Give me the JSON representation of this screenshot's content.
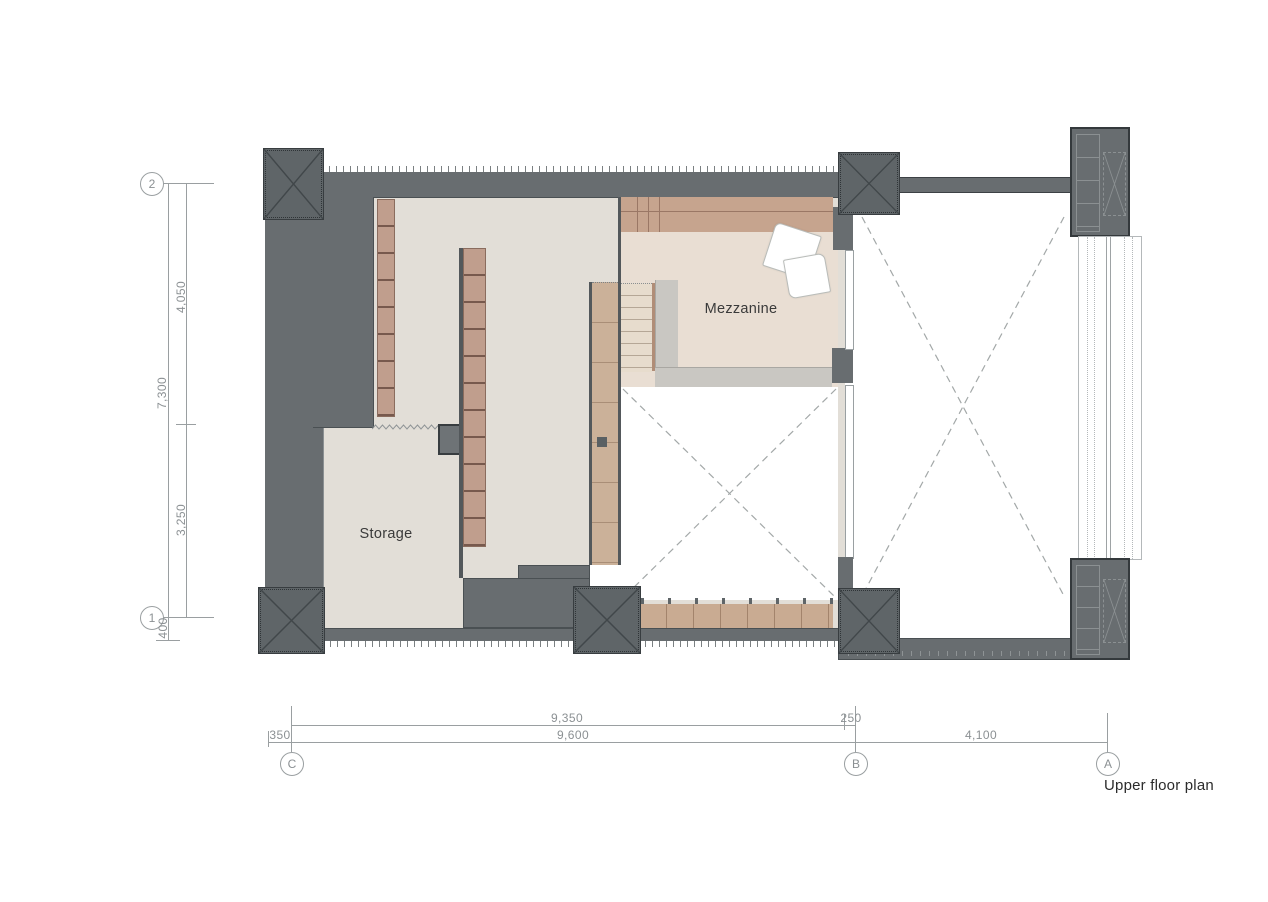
{
  "title": {
    "label": "Upper floor plan"
  },
  "rooms": {
    "storage": "Storage",
    "mezzanine": "Mezzanine"
  },
  "grid": {
    "h": {
      "g2": "2",
      "g1": "1"
    },
    "v": {
      "gC": "C",
      "gB": "B",
      "gA": "A"
    }
  },
  "dims": {
    "left": {
      "d4050": "4,050",
      "d7300": "7,300",
      "d3250": "3,250",
      "d400": "400"
    },
    "bottom": {
      "d9350": "9,350",
      "d250": "250",
      "d350": "350",
      "d9600": "9,600",
      "d4100": "4,100"
    }
  },
  "colors": {
    "wall": "#686d70",
    "column": "#5f6568",
    "floor": "#e2ded7",
    "mezzanine_floor": "#e9ded3",
    "wood_shelf": "#c09e8d",
    "wood_walkway": "#cbb199",
    "platform_edge": "#c9c7c2",
    "dimension": "#8b9093",
    "label": "#3a3a3a",
    "void_dash": "#a3a8a8"
  }
}
